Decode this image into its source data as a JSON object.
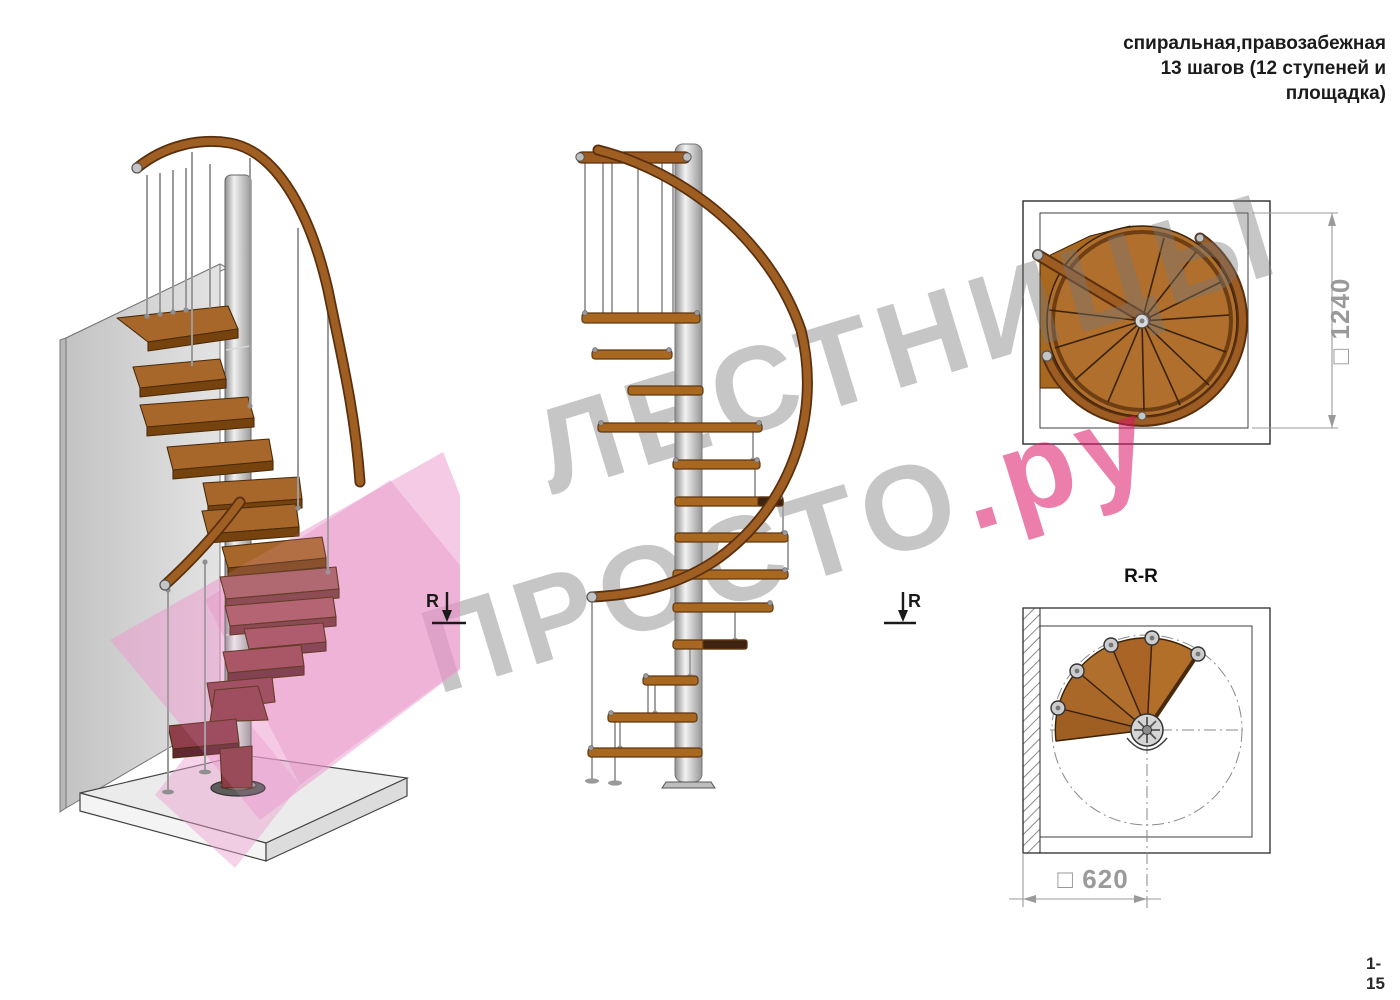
{
  "header": {
    "title_lines": [
      "спиральная,правозабежная",
      "13 шагов (12 ступеней и",
      "площадка)"
    ]
  },
  "watermark": {
    "line1": "ЛЕСТНИЦЫ",
    "line2_gray": "ПРОСТО",
    "line2_accent": ".ру",
    "gray_color": "#bfbfbf",
    "accent_color": "#e23a78"
  },
  "views": {
    "iso": {
      "section_marker_label": "R"
    },
    "elevation": {
      "section_marker_label": "R"
    },
    "plan": {
      "dimension_label": "□ 1240"
    },
    "section": {
      "title": "R-R",
      "dimension_label": "□ 620"
    }
  },
  "footer": {
    "page_number": "1-15"
  },
  "colors": {
    "wood": "#a9681f",
    "wood_dark": "#7a4517",
    "handrail": "#8a4a1a",
    "metal_light": "#e8e8e8",
    "metal_mid": "#b0b0b0",
    "pink_section_plane": "#ee9ed0",
    "dimension_gray": "#9a9a9a",
    "line_black": "#2b2b2b"
  }
}
